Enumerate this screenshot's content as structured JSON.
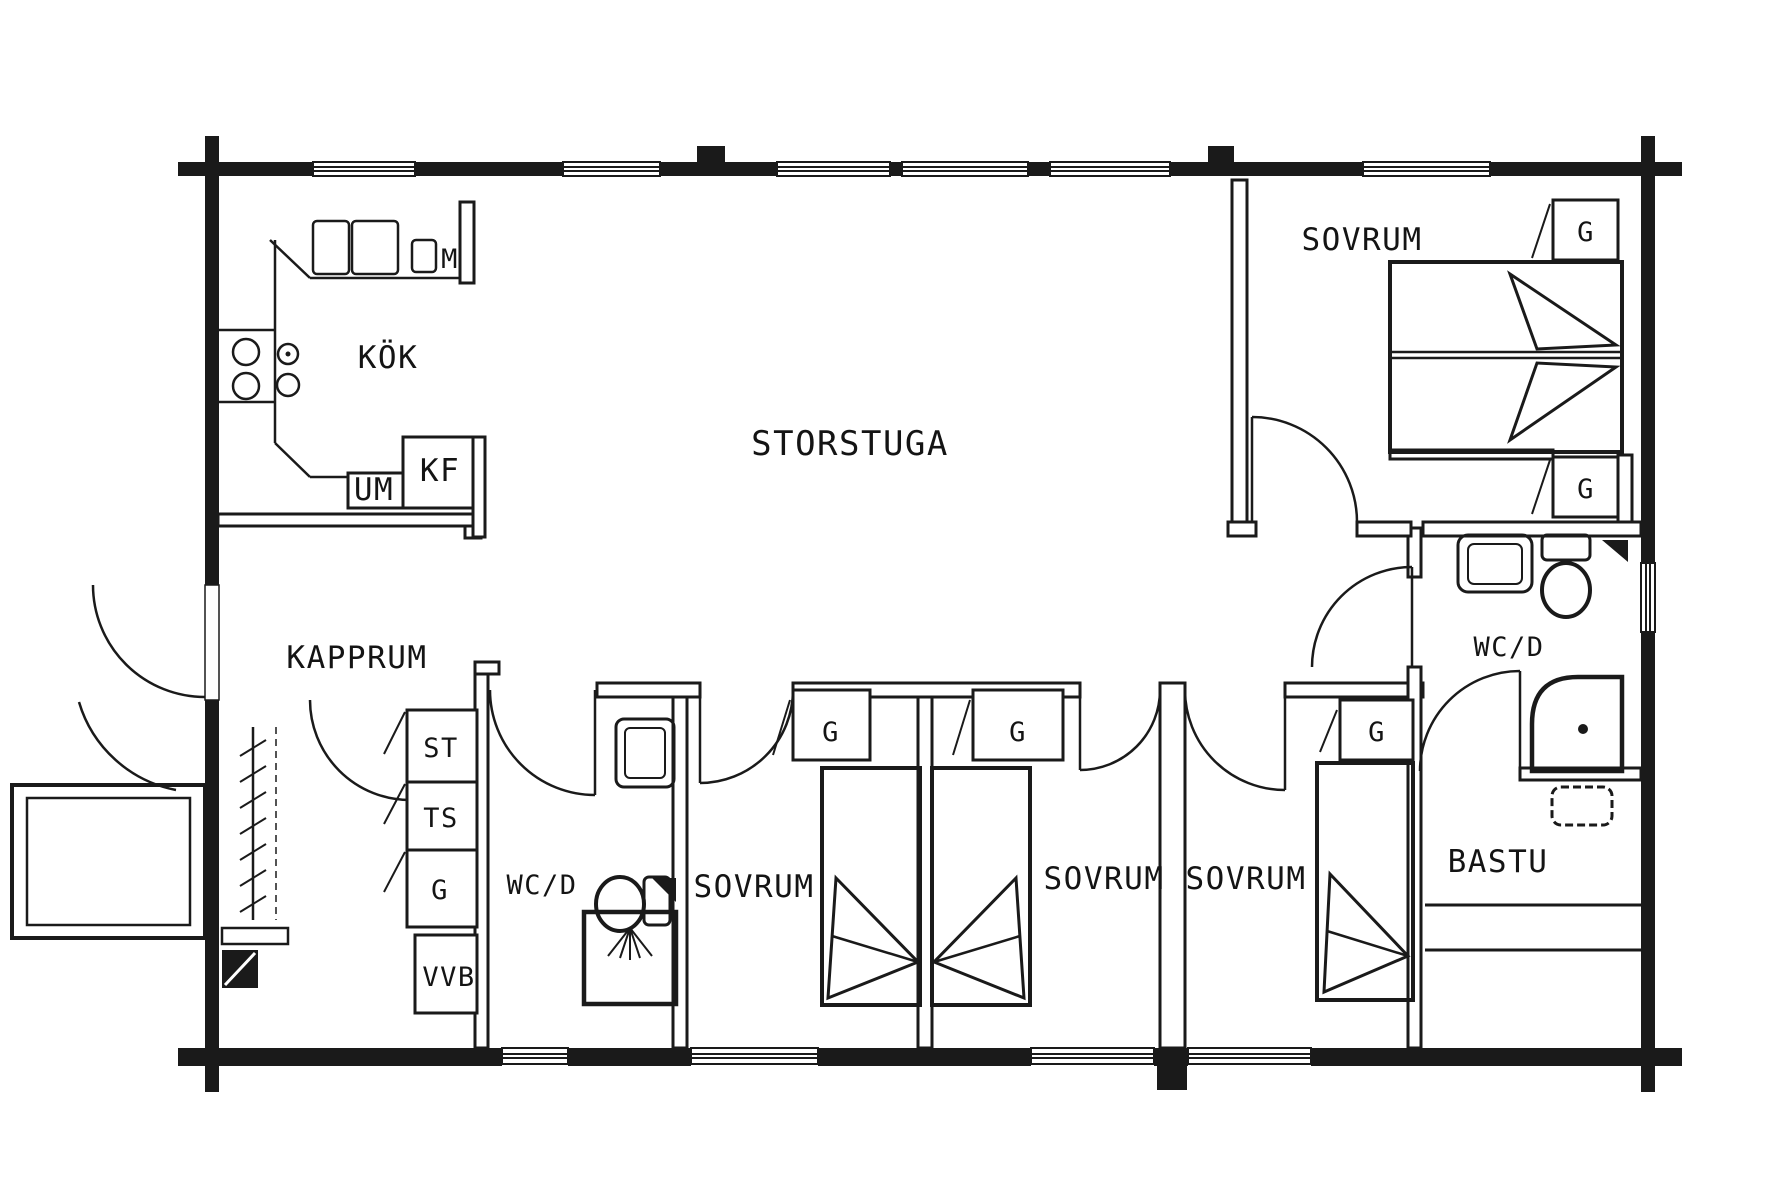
{
  "drawing": {
    "type": "architectural-floor-plan",
    "style": "black and white scanned log-cabin plan"
  },
  "colors": {
    "ink": "#1a1a1a",
    "paper": "#ffffff"
  },
  "labels": {
    "storstuga": "STORSTUGA",
    "kok": "KÖK",
    "kapprum": "KAPPRUM",
    "sovrum_top_right": "SOVRUM",
    "sovrum_mid_1": "SOVRUM",
    "sovrum_mid_2": "SOVRUM",
    "sovrum_mid_3": "SOVRUM",
    "wc_right": "WC/D",
    "wc_mid": "WC/D",
    "bastu": "BASTU",
    "closet_tr_1": "G",
    "closet_tr_2": "G",
    "closet_room1": "G",
    "closet_room2": "G",
    "closet_room3": "G",
    "cabinet_st": "ST",
    "cabinet_ts": "TS",
    "cabinet_g": "G",
    "water_heater": "VVB",
    "fridge_freezer": "KF",
    "dishwasher": "UM",
    "micro": "M"
  }
}
